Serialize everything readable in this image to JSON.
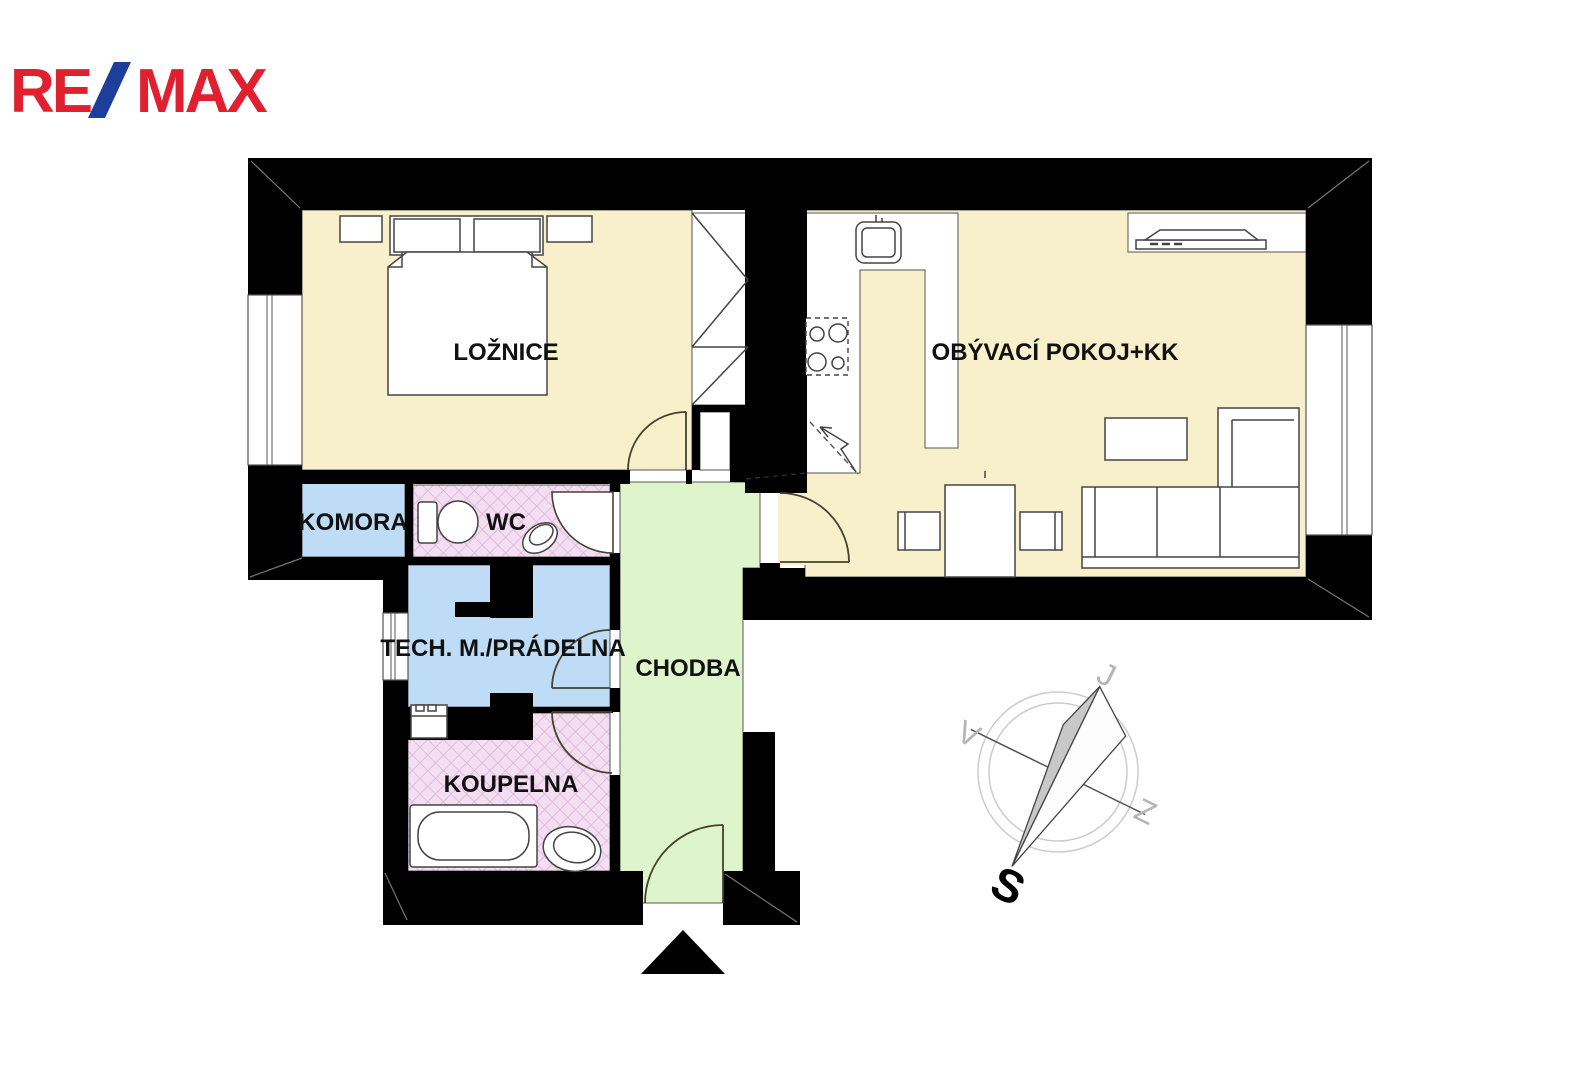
{
  "brand": {
    "re": "RE",
    "slash": "/",
    "max": "MAX"
  },
  "rooms": {
    "bedroom": {
      "label": "LOŽNICE"
    },
    "living": {
      "label": "OBÝVACÍ POKOJ+KK"
    },
    "pantry": {
      "label": "KOMORA"
    },
    "wc": {
      "label": "WC"
    },
    "utility": {
      "label": "TECH. M./PRÁDELNA"
    },
    "hall": {
      "label": "CHODBA"
    },
    "bathroom": {
      "label": "KOUPELNA"
    }
  },
  "compass": {
    "top": "J",
    "left": "V",
    "right": "Z",
    "bottom": "S"
  },
  "colors": {
    "wall": "#000000",
    "room_main": "#f8f0cb",
    "room_storage": "#bedcf5",
    "room_wet": "#f4def2",
    "room_wet_lines": "#ddb3da",
    "room_hall": "#def5cb",
    "brand_red": "#e0202f",
    "brand_blue": "#1e3e9c",
    "compass_ring": "#cccccc",
    "needle_fill": "#c8c8c8"
  }
}
